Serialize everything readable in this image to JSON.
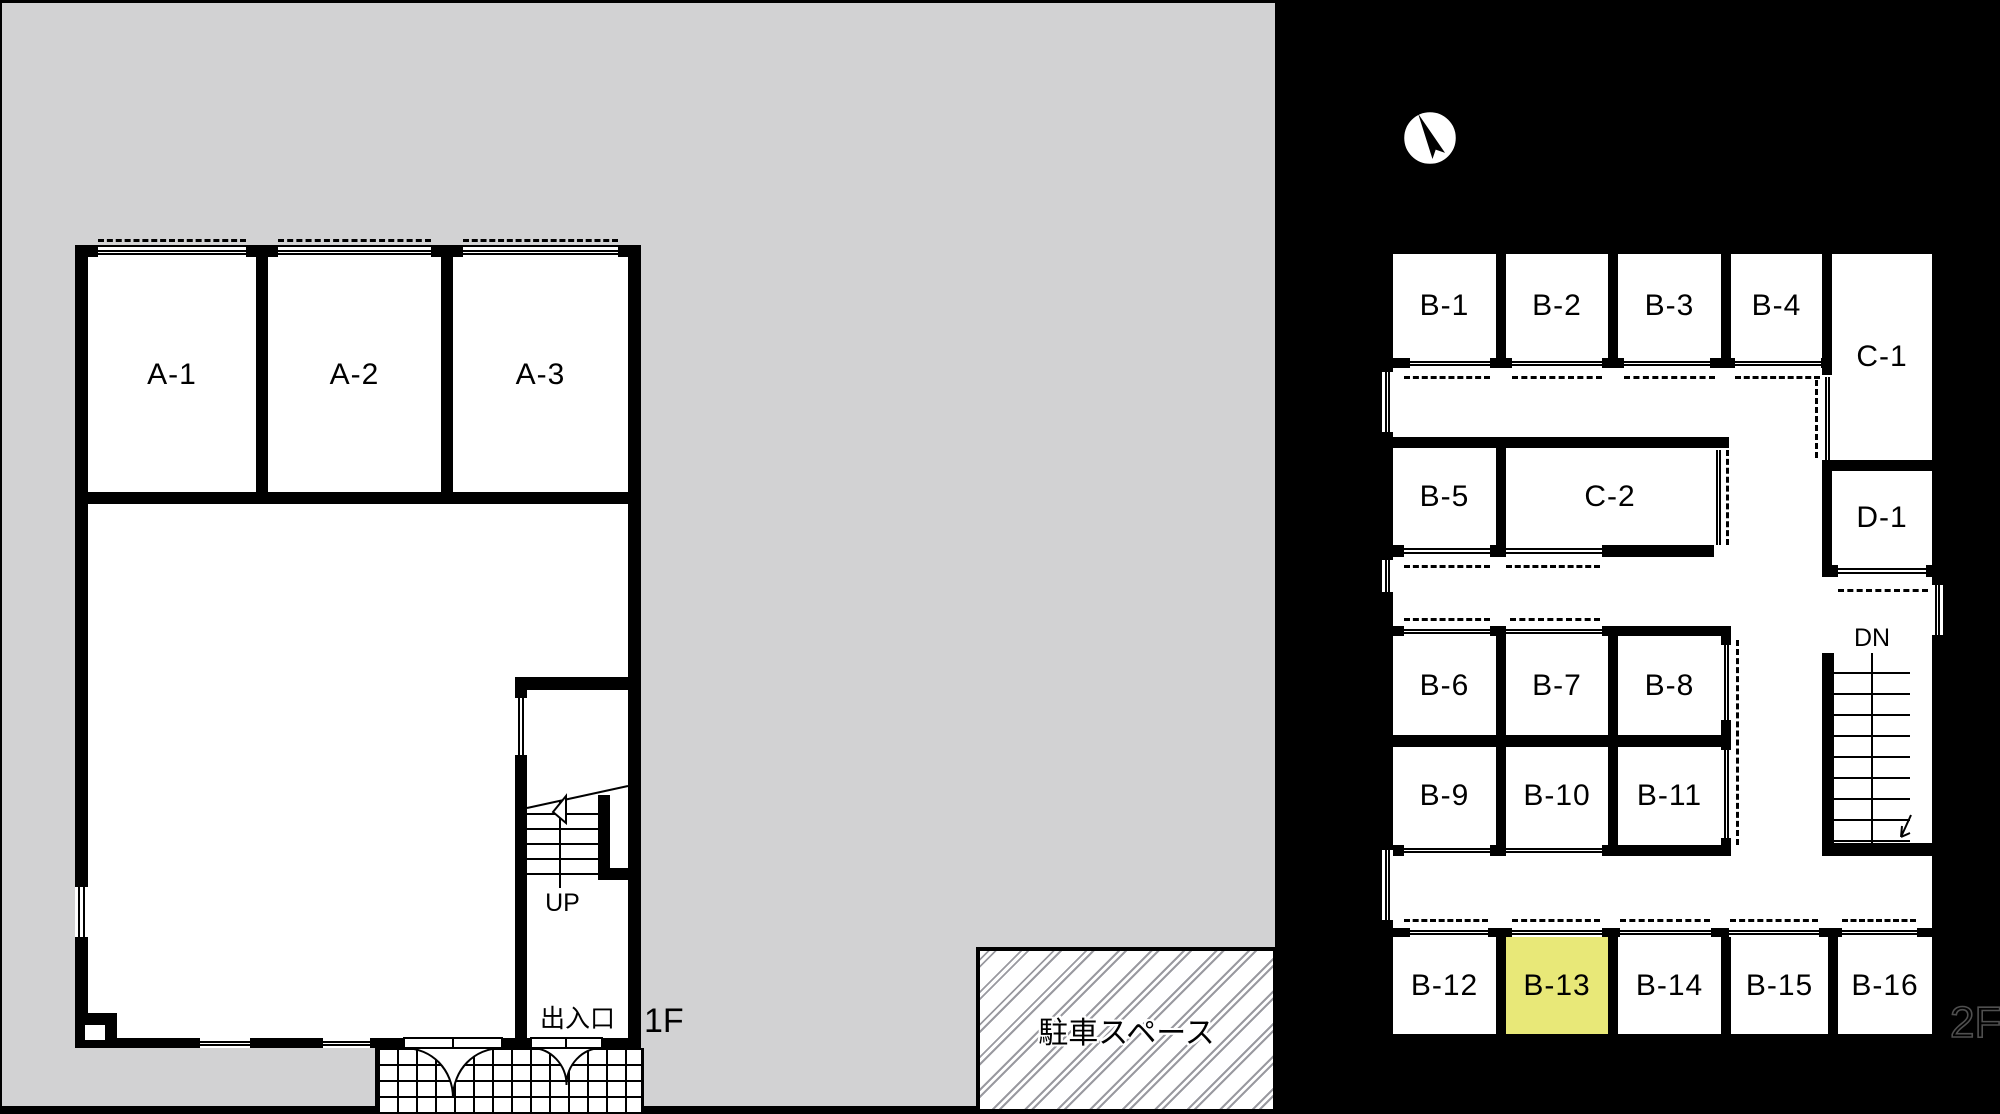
{
  "colors": {
    "background": "#000000",
    "site": "#d2d2d3",
    "wall": "#000000",
    "floor": "#ffffff",
    "highlight": "#e8e878",
    "hatch": "#9a9aa0"
  },
  "floor1": {
    "label": "1F",
    "rooms": [
      {
        "label": "A-1"
      },
      {
        "label": "A-2"
      },
      {
        "label": "A-3"
      }
    ],
    "stair_direction": "UP",
    "entrance": "出入口"
  },
  "floor2": {
    "label": "2F",
    "stair_direction": "DN",
    "highlighted_room": "B-13",
    "rooms": [
      {
        "label": "B-1"
      },
      {
        "label": "B-2"
      },
      {
        "label": "B-3"
      },
      {
        "label": "B-4"
      },
      {
        "label": "C-1"
      },
      {
        "label": "B-5"
      },
      {
        "label": "C-2"
      },
      {
        "label": "D-1"
      },
      {
        "label": "B-6"
      },
      {
        "label": "B-7"
      },
      {
        "label": "B-8"
      },
      {
        "label": "B-9"
      },
      {
        "label": "B-10"
      },
      {
        "label": "B-11"
      },
      {
        "label": "B-12"
      },
      {
        "label": "B-13"
      },
      {
        "label": "B-14"
      },
      {
        "label": "B-15"
      },
      {
        "label": "B-16"
      }
    ]
  },
  "parking": {
    "label": "駐車スペース"
  },
  "compass": {
    "label": "N"
  }
}
